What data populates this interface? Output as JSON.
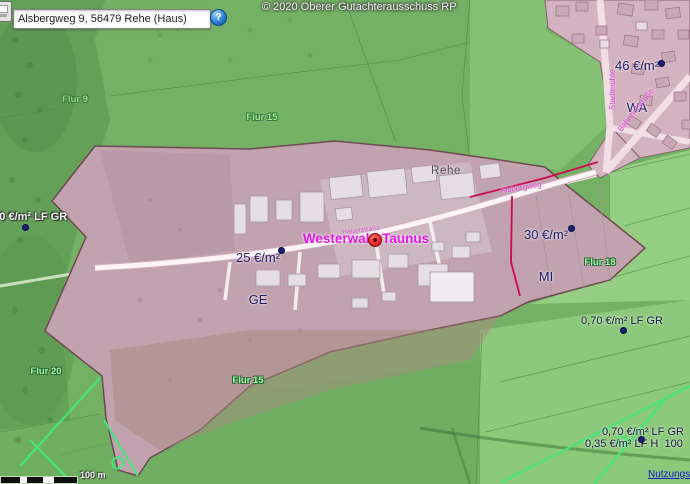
{
  "toolbar": {
    "search_value": "Alsbergweg 9, 56479 Rehe (Haus)",
    "help_label": "?"
  },
  "attribution": "© 2020 Oberer Gutachterausschuss RP",
  "map": {
    "town_label": "Rehe",
    "marker_label": "Westerwald-Taunus",
    "value_labels": [
      {
        "price": "46 €/m²",
        "zone": "WA"
      },
      {
        "price": "25 €/m²",
        "zone": "GE"
      },
      {
        "price": "30 €/m²",
        "zone": "MI"
      }
    ],
    "agri_labels": {
      "right": "0,70 €/m² LF GR",
      "bottom_1": "0,70 €/m² LF GR",
      "bottom_2": "0,35 €/m² LF H  100",
      "left": "0,70 €/m² LF GR"
    },
    "street_labels": {
      "alsbergweg": "Alsbergweg",
      "bahnhofstrasse": "Bahnhofstraße",
      "stadtmuehle": "Stadtmühle",
      "hauptstrasse": "Hauptstraße"
    },
    "flur_labels": {
      "f9": "Flur 9",
      "f15_top": "Flur 15",
      "f18": "Flur 18",
      "f20": "Flur 20",
      "f15_bottom": "Flur 15"
    },
    "scale_label": "100 m",
    "link_label": "Nutzungsbedingungen"
  },
  "colors": {
    "base_green": "#74b164",
    "built_up_pink": "#c2a2ae",
    "village_pink": "#d4b3c0",
    "value_text": "#1d1d6b",
    "marker_magenta": "#e513e5",
    "boundary_crimson": "#cc0a4e",
    "parcel_neon": "#44e87c",
    "link_blue": "#1313cc"
  }
}
